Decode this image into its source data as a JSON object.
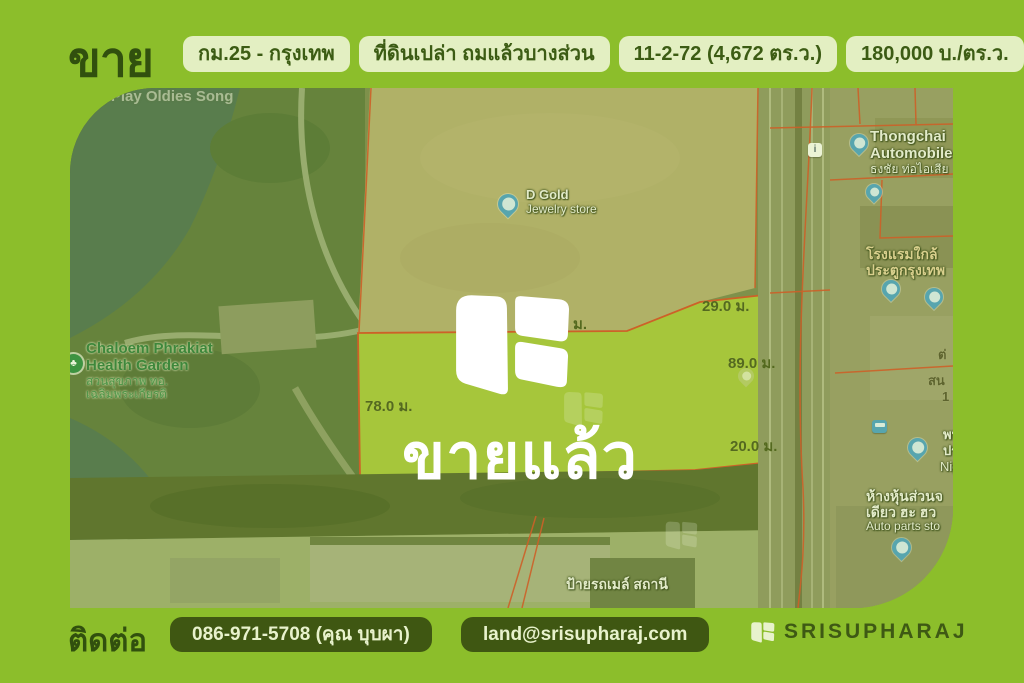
{
  "header": {
    "title": "ขาย",
    "badges": [
      {
        "label": "กม.25 - กรุงเทพ"
      },
      {
        "label": "ที่ดินเปล่า ถมแล้วบางส่วน"
      },
      {
        "label": "11-2-72 (4,672 ตร.ว.)"
      },
      {
        "label": "180,000 บ./ตร.ว."
      }
    ]
  },
  "map": {
    "sold_overlay": "ขายแล้ว",
    "measurements": {
      "north": "29.0 ม.",
      "east": "89.0 ม.",
      "south_east": "20.0 ม.",
      "west": "78.0 ม.",
      "hidden_partial": "ม."
    },
    "labels": {
      "d_gold": {
        "line1": "D Gold",
        "line2": "Jewelry store"
      },
      "health_garden": {
        "line1": "Chaloem Phrakiat",
        "line2": "Health Garden",
        "line3": "สวนสุขภาพ ทอ.",
        "line4": "เฉลิมพระเกียรติ"
      },
      "thongchai": {
        "line1": "Thongchai",
        "line2": "Automobile",
        "line3": "ธงชัย ท่อไอเสีย"
      },
      "hotel": {
        "line1": "โรงแรมใกล้",
        "line2": "ประตูกรุงเทพ"
      },
      "long_play": {
        "line1": "Long Play Oldies Song"
      },
      "bus_stop": {
        "line1": "ป้ายรถเมล์ สถานี"
      },
      "auto_parts": {
        "line1": "ห้างหุ้นส่วนจ",
        "line2": "เดียว ฮะ ฮว",
        "line3": "Auto parts sto"
      },
      "edge_partials": {
        "p1": "ต่",
        "p2": "สน",
        "p3": "1",
        "p4": "พห",
        "p5": "ปร",
        "p6": "Nig"
      },
      "info_icon_glyph": "i",
      "park_icon_glyph": "♣"
    }
  },
  "footer": {
    "contact_label": "ติดต่อ",
    "phone": "086-971-5708 (คุณ บุบผา)",
    "email": "land@srisupharaj.com",
    "brand": "SRISUPHARAJ"
  },
  "colors": {
    "frame_green": "#8CBE2B",
    "dark_green": "#31500E",
    "badge_bg": "#E3EFC2",
    "pill_bg": "#3F5712",
    "pill_text": "#E8F2CC",
    "plot_highlight": "#ABC73E",
    "parcel_line_red": "#D94F28",
    "pin_blue": "#4DA0C8"
  }
}
